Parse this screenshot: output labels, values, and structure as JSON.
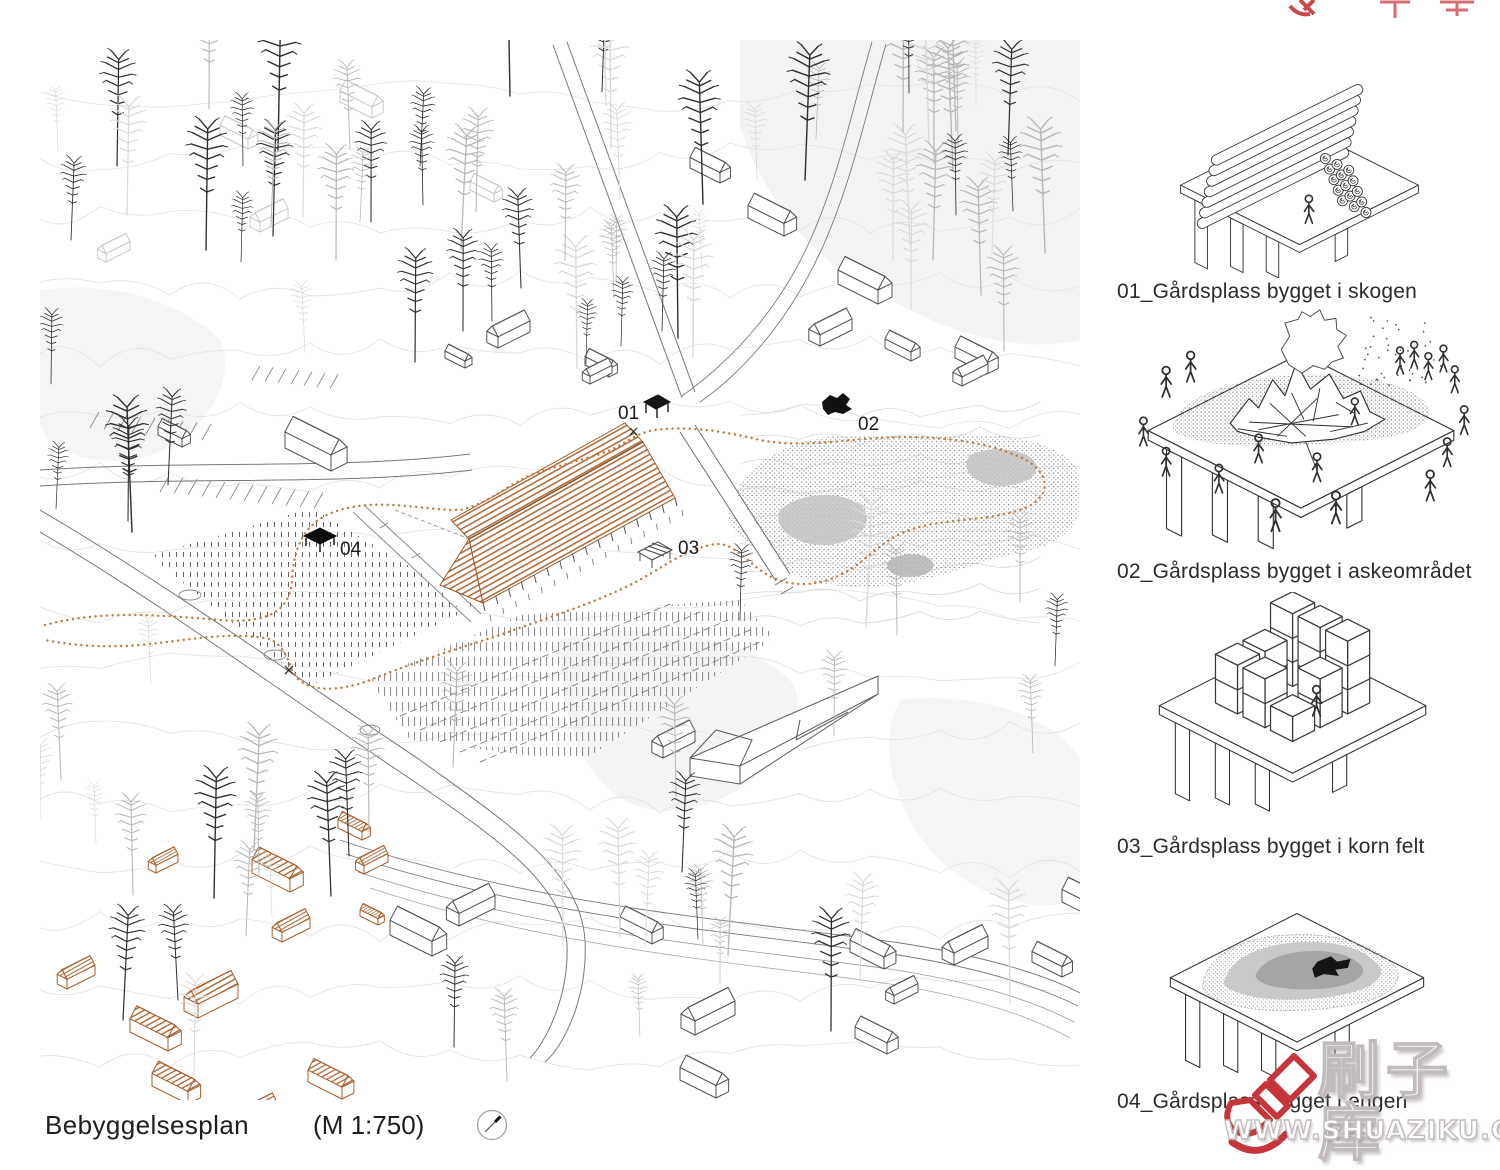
{
  "plan": {
    "title": "Bebyggelsesplan",
    "scale": "(M 1:750)",
    "markers": [
      {
        "id": "01"
      },
      {
        "id": "02"
      },
      {
        "id": "03"
      },
      {
        "id": "04"
      }
    ],
    "path_color": "#c07a3e",
    "building_color": "#ad6432"
  },
  "legend": {
    "items": [
      {
        "id": "01",
        "caption": "01_Gårdsplass bygget i skogen",
        "illustration": "timber-stack-courtyard"
      },
      {
        "id": "02",
        "caption": "02_Gårdsplass bygget i askeområdet",
        "illustration": "bonfire-courtyard"
      },
      {
        "id": "03",
        "caption": "03_Gårdsplass bygget i korn felt",
        "illustration": "hay-bale-courtyard"
      },
      {
        "id": "04",
        "caption": "04_Gårdsplass bygget i engen",
        "illustration": "ash-meadow-courtyard"
      }
    ]
  },
  "watermark": {
    "logo_text": "刷子库",
    "url": "WWW.SHUAZIKU.COM",
    "brush_icon_color": "#c5353a"
  }
}
